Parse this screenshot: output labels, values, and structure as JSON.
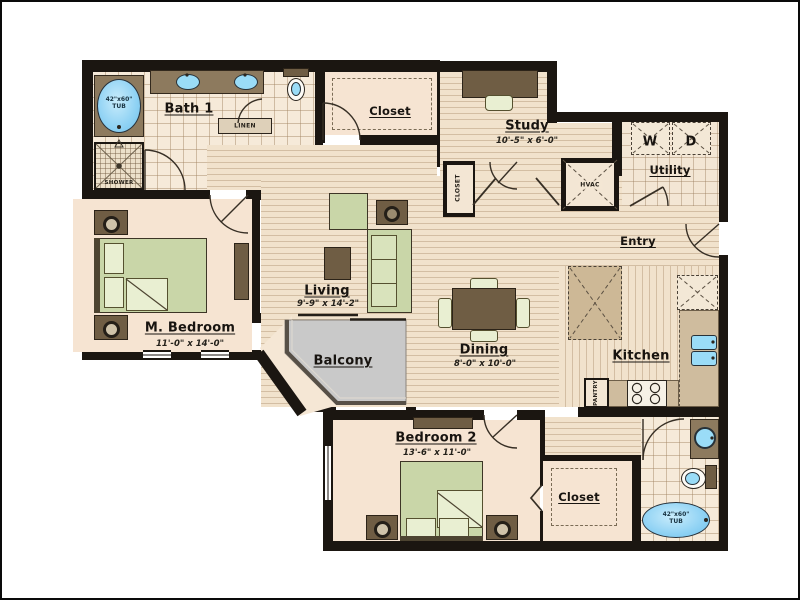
{
  "floorplan": {
    "rooms": {
      "bath1": {
        "name": "Bath 1"
      },
      "master_closet": {
        "name": "Closet"
      },
      "study": {
        "name": "Study",
        "dims": "10'-5\" x 6'-0\""
      },
      "utility": {
        "name": "Utility"
      },
      "entry": {
        "name": "Entry"
      },
      "master_bedroom": {
        "name": "M. Bedroom",
        "dims": "11'-0\" x 14'-0\""
      },
      "living": {
        "name": "Living",
        "dims": "9'-9\" x 14'-2\""
      },
      "balcony": {
        "name": "Balcony"
      },
      "dining": {
        "name": "Dining",
        "dims": "8'-0\" x 10'-0\""
      },
      "kitchen": {
        "name": "Kitchen"
      },
      "bedroom2": {
        "name": "Bedroom 2",
        "dims": "13'-6\" x 11'-0\""
      },
      "closet2": {
        "name": "Closet"
      }
    },
    "labels": {
      "master_tub_size": "42\"x60\"",
      "master_tub": "TUB",
      "shower": "SHOWER",
      "linen": "LINEN",
      "hall_closet": "CLOSET",
      "hvac": "HVAC",
      "washer": "W",
      "dryer": "D",
      "pantry": "PANTRY",
      "bath2_tub_size": "42\"x60\"",
      "bath2_tub": "TUB"
    },
    "colors": {
      "wall": "#1b1611",
      "floor": "#f6e4d2",
      "wood": "#f1e2cc",
      "tile_line": "#cdb9a1",
      "fixture_blue": "#8fd2f4",
      "furniture_brown": "#8d7a5e",
      "bed_green": "#c9d6a8",
      "balcony_gray": "#c9c9c9"
    }
  }
}
